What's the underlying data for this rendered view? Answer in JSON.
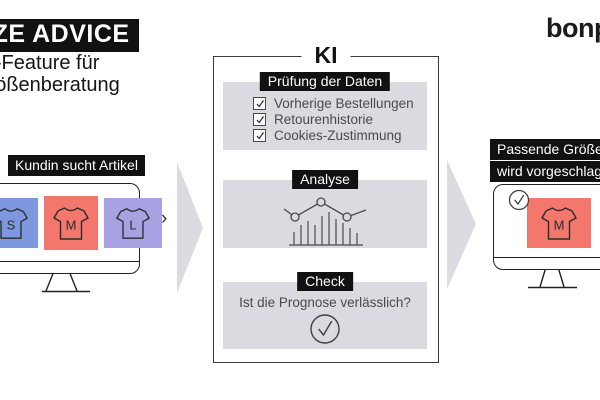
{
  "header": {
    "title": "SIZE ADVICE",
    "subtitle_line1": "KI-Feature für",
    "subtitle_line2": "Größenberatung",
    "brand": "bonprix"
  },
  "flow": {
    "left": {
      "label": "Kundin sucht Artikel",
      "tiles": [
        {
          "size": "S",
          "color": "#7d98de"
        },
        {
          "size": "M",
          "color": "#f3776c"
        },
        {
          "size": "L",
          "color": "#a7a3e2"
        }
      ],
      "carousel_next": "›"
    },
    "ki": {
      "title": "KI",
      "sections": [
        {
          "label": "Prüfung der Daten",
          "items": [
            "Vorherige Bestellungen",
            "Retourenhistorie",
            "Cookies-Zustimmung"
          ]
        },
        {
          "label": "Analyse"
        },
        {
          "label": "Check",
          "question": "Ist die Prognose verlässlich?"
        }
      ]
    },
    "right": {
      "label_line1": "Passende Größe",
      "label_line2": "wird vorgeschlagen",
      "tile": {
        "size": "M",
        "color": "#f3776c"
      }
    }
  },
  "colors": {
    "section_bg": "#dbdae0",
    "arrow": "#dcdbe2",
    "label_bg": "#111111",
    "outline": "#2b2b2b"
  }
}
